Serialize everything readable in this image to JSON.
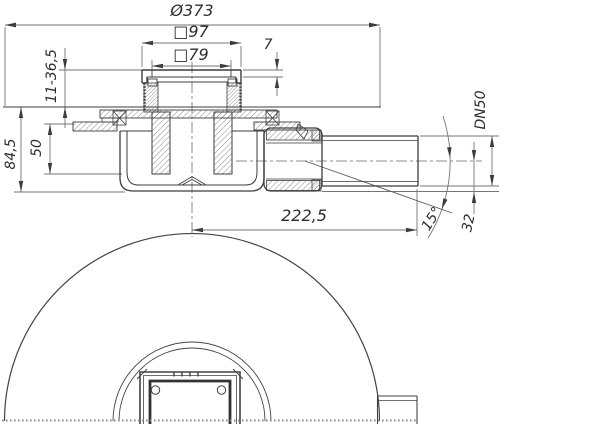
{
  "labels": {
    "flange_diameter": "Ø373",
    "frame_outer": "□97",
    "grate_inner": "□79",
    "cover_thickness": "7",
    "height_adjust_range": "11-36,5",
    "installation_depth": "84,5",
    "water_seal_depth": "50",
    "outlet_size": "DN50",
    "outlet_length": "222,5",
    "swivel_angle": "15°",
    "axis_to_base": "32"
  },
  "colors": {
    "line_main": "#3d3d3d",
    "line_dim": "#757575",
    "text": "#2d2d2d",
    "background": "#ffffff"
  }
}
